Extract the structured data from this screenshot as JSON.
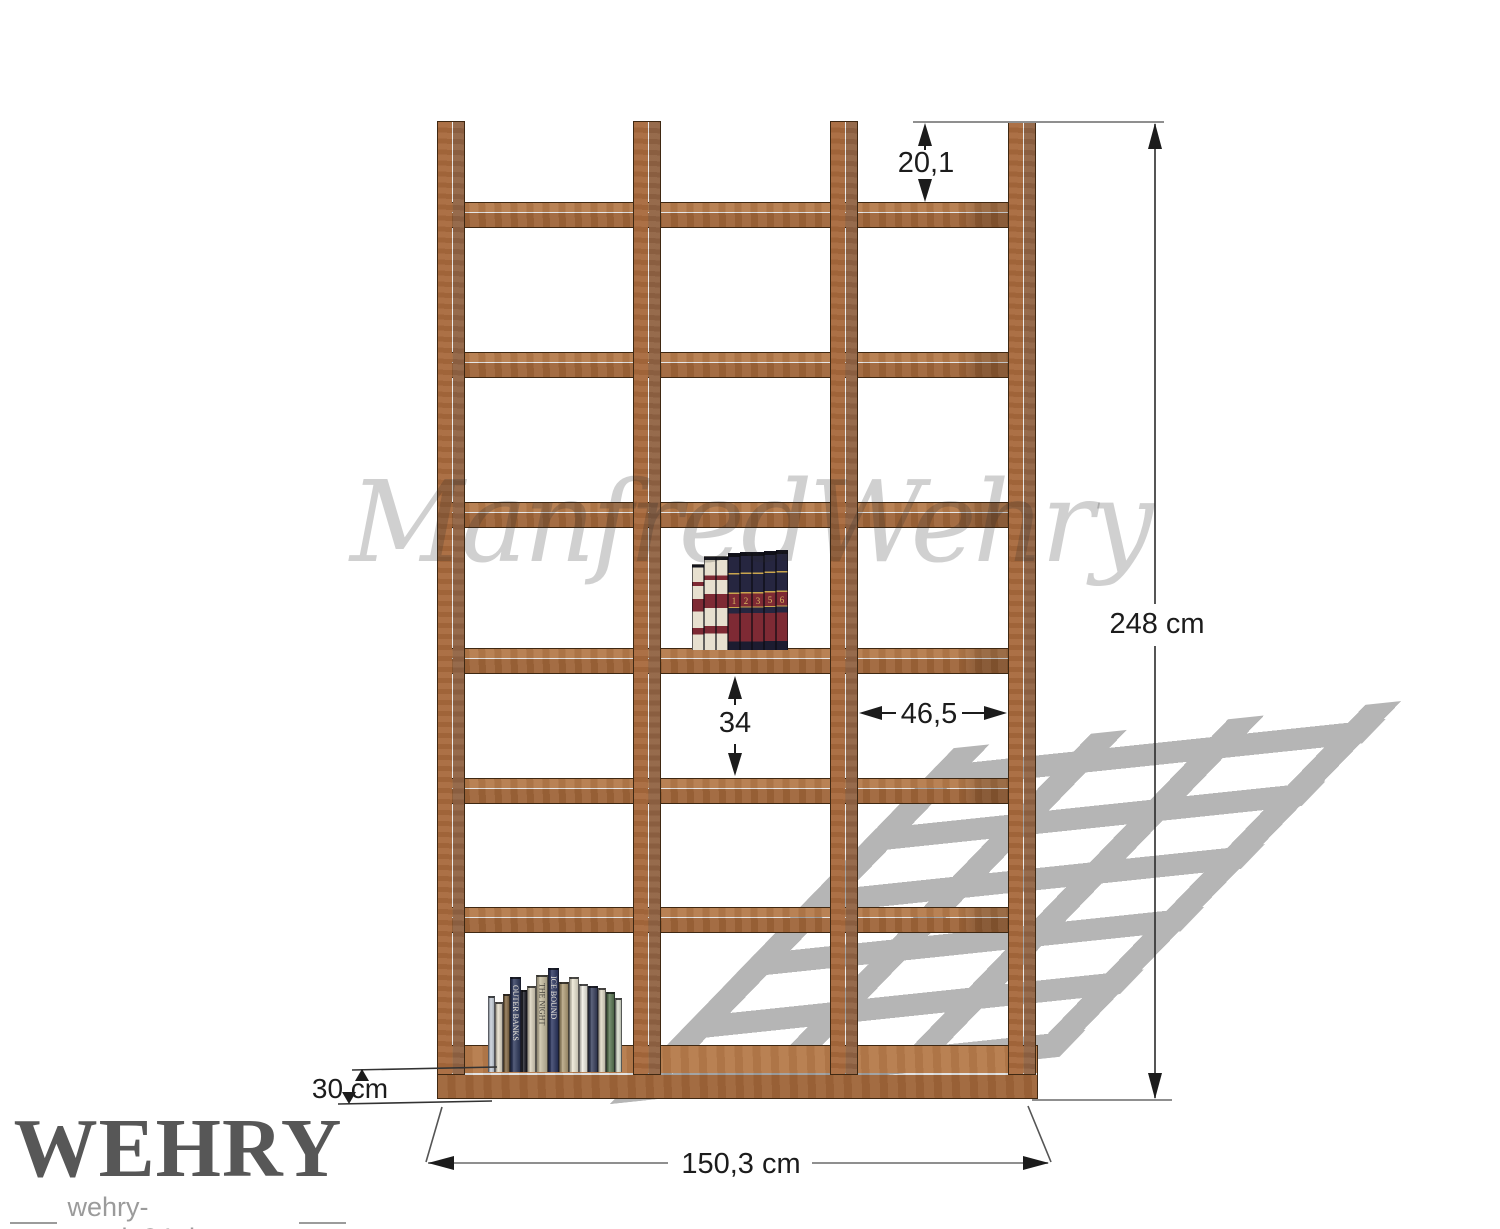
{
  "annotations": {
    "top_offset": "20,1",
    "total_height": "248 cm",
    "compartment_height": "34",
    "compartment_width": "46,5",
    "depth": "30 cm",
    "total_width": "150,3 cm"
  },
  "watermark": {
    "text": "ManfredWehry"
  },
  "logo": {
    "brand": "WEHRY",
    "site": "wehry-regale24.de"
  },
  "shelf_structure": {
    "columns": 3,
    "rows": 6,
    "boards": 7,
    "uprights": 4
  },
  "colors": {
    "wood_top": "#b57a4a",
    "wood_front": "#9e6438",
    "upright_front": "#a8693c",
    "upright_side": "#916343",
    "outline": "#3f2812",
    "shadow": "#b5b5b5",
    "dim_dark": "#2b2b2b",
    "dim_gray": "#8f8f8f",
    "watermark_gray": "rgba(40,40,40,0.22)",
    "logo_gray": "#575757",
    "logo_sub_gray": "#9b9b9b"
  },
  "books_left": [
    {
      "w": 7,
      "h": 76,
      "c": "#cdd6e0"
    },
    {
      "w": 8,
      "h": 70,
      "c": "#e9e2cf"
    },
    {
      "w": 7,
      "h": 78,
      "c": "#8a6f4a"
    },
    {
      "w": 11,
      "h": 95,
      "c": "#2f3a5e",
      "title": "OUTER BANKS",
      "tc": "#e8e4da"
    },
    {
      "w": 6,
      "h": 82,
      "c": "#23252d"
    },
    {
      "w": 9,
      "h": 86,
      "c": "#ded6bf"
    },
    {
      "w": 12,
      "h": 97,
      "c": "#c9bfa2",
      "title": "THE NIGHT",
      "tc": "#43403a"
    },
    {
      "w": 11,
      "h": 104,
      "c": "#2c3660",
      "title": "ICE BOUND",
      "tc": "#e8e4da"
    },
    {
      "w": 10,
      "h": 90,
      "c": "#b3a07a"
    },
    {
      "w": 10,
      "h": 95,
      "c": "#efe9d6"
    },
    {
      "w": 9,
      "h": 88,
      "c": "#f4f1e8"
    },
    {
      "w": 10,
      "h": 86,
      "c": "#39425f"
    },
    {
      "w": 8,
      "h": 84,
      "c": "#e4decb"
    },
    {
      "w": 9,
      "h": 80,
      "c": "#5d7a55"
    },
    {
      "w": 7,
      "h": 74,
      "c": "#dfe4d4"
    }
  ],
  "books_encyclopedia": [
    {
      "style": "cream",
      "h": 86,
      "num": ""
    },
    {
      "style": "cream",
      "h": 94,
      "num": ""
    },
    {
      "style": "cream",
      "h": 94,
      "num": ""
    },
    {
      "style": "navy",
      "h": 97,
      "num": "1"
    },
    {
      "style": "navy",
      "h": 98,
      "num": "2"
    },
    {
      "style": "navy",
      "h": 98,
      "num": "3"
    },
    {
      "style": "navy",
      "h": 99,
      "num": "5"
    },
    {
      "style": "navy",
      "h": 100,
      "num": "6"
    }
  ]
}
